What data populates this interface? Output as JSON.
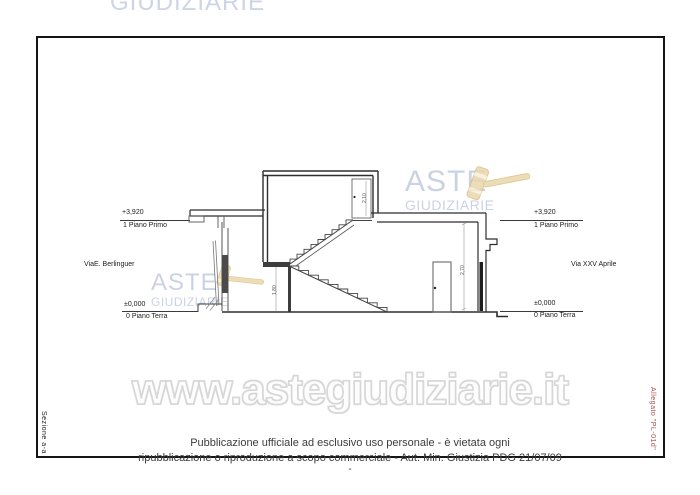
{
  "watermarks": {
    "top_partial_text": "GIUDIZIARIE",
    "aste_logo": {
      "line1": "ASTE",
      "line2": "GIUDIZIARIE"
    },
    "site_url": "www.astegiudiziarie.it",
    "colors": {
      "logo_blue": "#c6cfe2",
      "gavel_tan": "#e9d7ac",
      "gavel_outline": "#d9c183",
      "url_outline": "#d6d6d6"
    }
  },
  "sheet": {
    "left_edge_label": "Sezione a-a",
    "right_edge_label": "Allegato \"PL-01d\"",
    "right_edge_label_color": "#a74b4b"
  },
  "drawing": {
    "levels_left": {
      "upper_value": "+3,920",
      "upper_floor": "1 Piano Primo",
      "lower_value": "±0,000",
      "lower_floor": "0 Piano Terra"
    },
    "levels_right": {
      "upper_value": "+3,920",
      "upper_floor": "1 Piano Primo",
      "lower_value": "±0,000",
      "lower_floor": "0 Piano Terra"
    },
    "street_left": "ViaE. Berlinguer",
    "street_right": "Via XXV Aprile",
    "dim_tower_door": "2,10",
    "dim_stair": "1,80",
    "dim_ground_floor": "2,70"
  },
  "footer": {
    "line1": "Pubblicazione ufficiale ad esclusivo uso personale - è vietata ogni",
    "line2": "ripubblicazione o riproduzione a scopo commerciale - Aut. Min. Giustizia PDG 21/07/09",
    "dash": "-"
  }
}
